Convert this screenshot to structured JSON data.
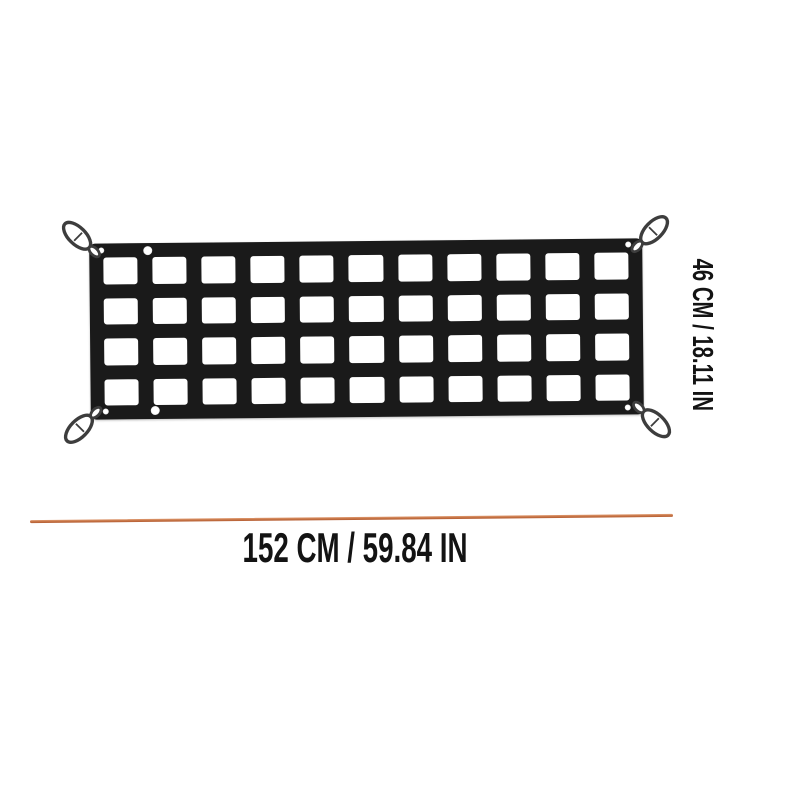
{
  "image": {
    "background_color": "#ffffff",
    "description": "Product dimension diagram of a black webbing cargo net with four corner carabiner hooks"
  },
  "product": {
    "name": "cargo-net",
    "net_color": "#1a1a1a",
    "grid": {
      "columns": 11,
      "rows": 4
    },
    "hooks": {
      "count": 4,
      "positions": [
        "top-left",
        "top-right",
        "bottom-left",
        "bottom-right"
      ],
      "outline_color": "#3d3d3d"
    },
    "grommet_color": "#ffffff"
  },
  "annotations": {
    "height_label": "46 CM / 18.11 IN",
    "width_label": "152 CM / 59.84 IN",
    "width_line_color": "#c47142",
    "text_color": "#131313"
  }
}
